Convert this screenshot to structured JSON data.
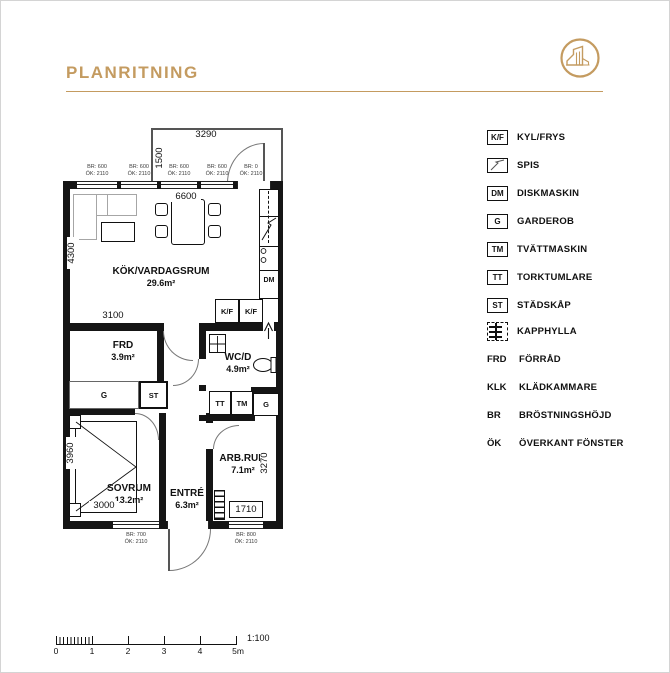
{
  "header": {
    "title": "PLANRITNING"
  },
  "plan": {
    "rooms": {
      "kitchen_living": {
        "name": "KÖK/VARDAGSRUM",
        "area": "29.6m²"
      },
      "frd": {
        "name": "FRD",
        "area": "3.9m²"
      },
      "wc": {
        "name": "WC/D",
        "area": "4.9m²"
      },
      "bedroom": {
        "name": "SOVRUM",
        "area": "13.2m²"
      },
      "entry": {
        "name": "ENTRÉ",
        "area": "6.3m²"
      },
      "workroom": {
        "name": "ARB.RUM",
        "area": "7.1m²"
      }
    },
    "dimensions": {
      "balcony_width": "3290",
      "balcony_depth": "1500",
      "living_width": "6600",
      "living_depth": "4300",
      "frd_width": "3100",
      "bedroom_depth": "3960",
      "bedroom_width": "3000",
      "workroom_depth": "3270",
      "workroom_window": "1710"
    },
    "appliances": {
      "kf": "K/F",
      "dm": "DM",
      "tt": "TT",
      "tm": "TM",
      "g": "G",
      "st": "ST"
    },
    "window_annotations_top": [
      {
        "br": "BR: 600",
        "ok": "ÖK: 2110"
      },
      {
        "br": "BR: 600",
        "ok": "ÖK: 2110"
      },
      {
        "br": "BR: 600",
        "ok": "ÖK: 2110"
      },
      {
        "br": "BR: 600",
        "ok": "ÖK: 2110"
      },
      {
        "br": "BR: 0",
        "ok": "ÖK: 2110"
      }
    ],
    "window_annotations_bottom": [
      {
        "br": "BR: 700",
        "ok": "ÖK: 2110"
      },
      {
        "br": "BR: 800",
        "ok": "ÖK: 2110"
      }
    ]
  },
  "legend": {
    "items": [
      {
        "abbr": "K/F",
        "label": "KYL/FRYS"
      },
      {
        "abbr": "",
        "label": "SPIS"
      },
      {
        "abbr": "DM",
        "label": "DISKMASKIN"
      },
      {
        "abbr": "G",
        "label": "GARDEROB"
      },
      {
        "abbr": "TM",
        "label": "TVÄTTMASKIN"
      },
      {
        "abbr": "TT",
        "label": "TORKTUMLARE"
      },
      {
        "abbr": "ST",
        "label": "STÄDSKÅP"
      },
      {
        "abbr": "",
        "label": "KAPPHYLLA"
      },
      {
        "abbr": "FRD",
        "label": "FÖRRÅD"
      },
      {
        "abbr": "KLK",
        "label": "KLÄDKAMMARE"
      },
      {
        "abbr": "BR",
        "label": "BRÖSTNINGSHÖJD"
      },
      {
        "abbr": "ÖK",
        "label": "ÖVERKANT FÖNSTER"
      }
    ]
  },
  "scalebar": {
    "labels": [
      "0",
      "1",
      "2",
      "3",
      "4",
      "5m"
    ],
    "ratio": "1:100"
  },
  "colors": {
    "gold": "#c49b60"
  }
}
